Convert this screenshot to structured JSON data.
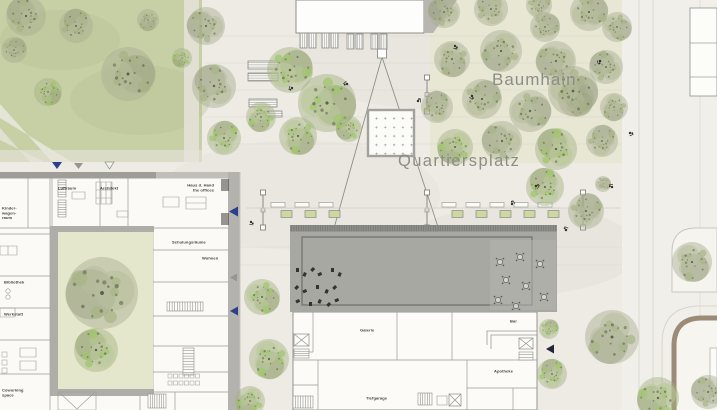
{
  "plan": {
    "area_labels": {
      "baumhain": "Baumhain",
      "quartiersplatz": "Quartiersplatz"
    },
    "left_building_rooms": {
      "luftraum": "Luftraum",
      "architekt": "Architekt",
      "offices_line1": "Haus d. Hand",
      "offices_line2": "the offices",
      "kinder_line1": "Kinder-",
      "kinder_line2": "wagen-",
      "kinder_line3": "raum",
      "schulungsraeume": "Schulungsräume",
      "wohnen": "Wohnen",
      "bibliothek": "Bibliothek",
      "werkstatt": "Werkstatt",
      "coworking_line1": "Coworking",
      "coworking_line2": "space"
    },
    "main_building_rooms": {
      "galerie": "Galerie",
      "bar": "Bar",
      "apotheke": "Apotheke",
      "tiefgarage": "Tiefgarage"
    },
    "colors": {
      "lawn": "#c7cfa5",
      "grove_ground": "#e7e7d3",
      "plaza": "#edebe4",
      "street": "#f1efe9",
      "roof": "#a8a8a3",
      "wall": "#b3b2ac",
      "accent_blue": "#2b3f8c",
      "path_brown": "#9c8c77",
      "label_gray": "#8d8d88",
      "planter_green": "#cdd7a2"
    }
  }
}
